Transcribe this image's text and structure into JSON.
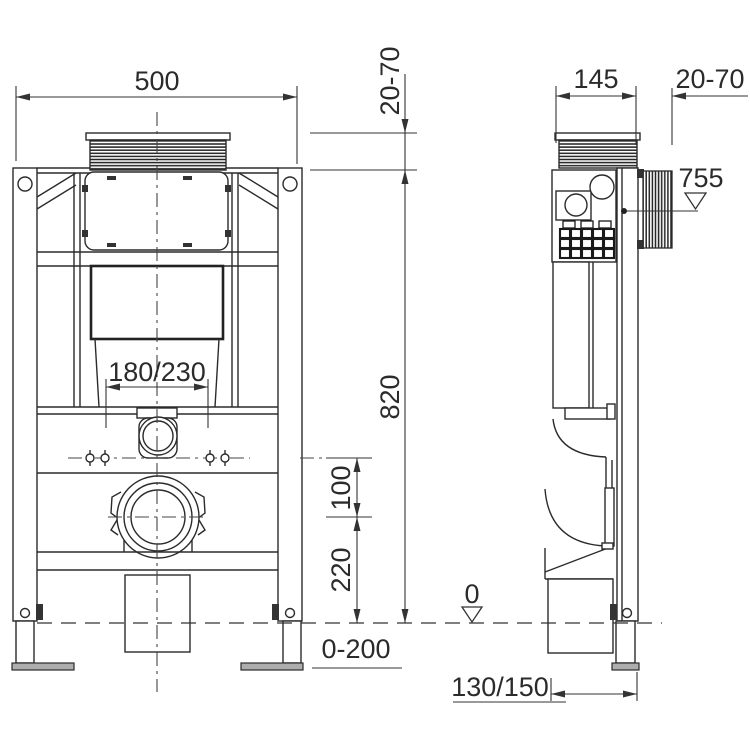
{
  "page": {
    "background": "#ffffff",
    "line_color": "#2b2b2b",
    "description_labels_only": true
  },
  "front_view": {
    "dim_width": "500",
    "dim_cover_depth": "20-70",
    "dim_flush_bend_spacing": "180/230",
    "dim_frame_height": "820",
    "dim_inlet_to_drain": "100",
    "dim_drain_center_height": "220",
    "dim_foot_extension": "0-200",
    "datum_floor": "0"
  },
  "side_view": {
    "dim_frame_depth": "145",
    "dim_wall_clearance": "20-70",
    "datum_actuator_height": "755",
    "dim_drain_offset": "130/150"
  }
}
